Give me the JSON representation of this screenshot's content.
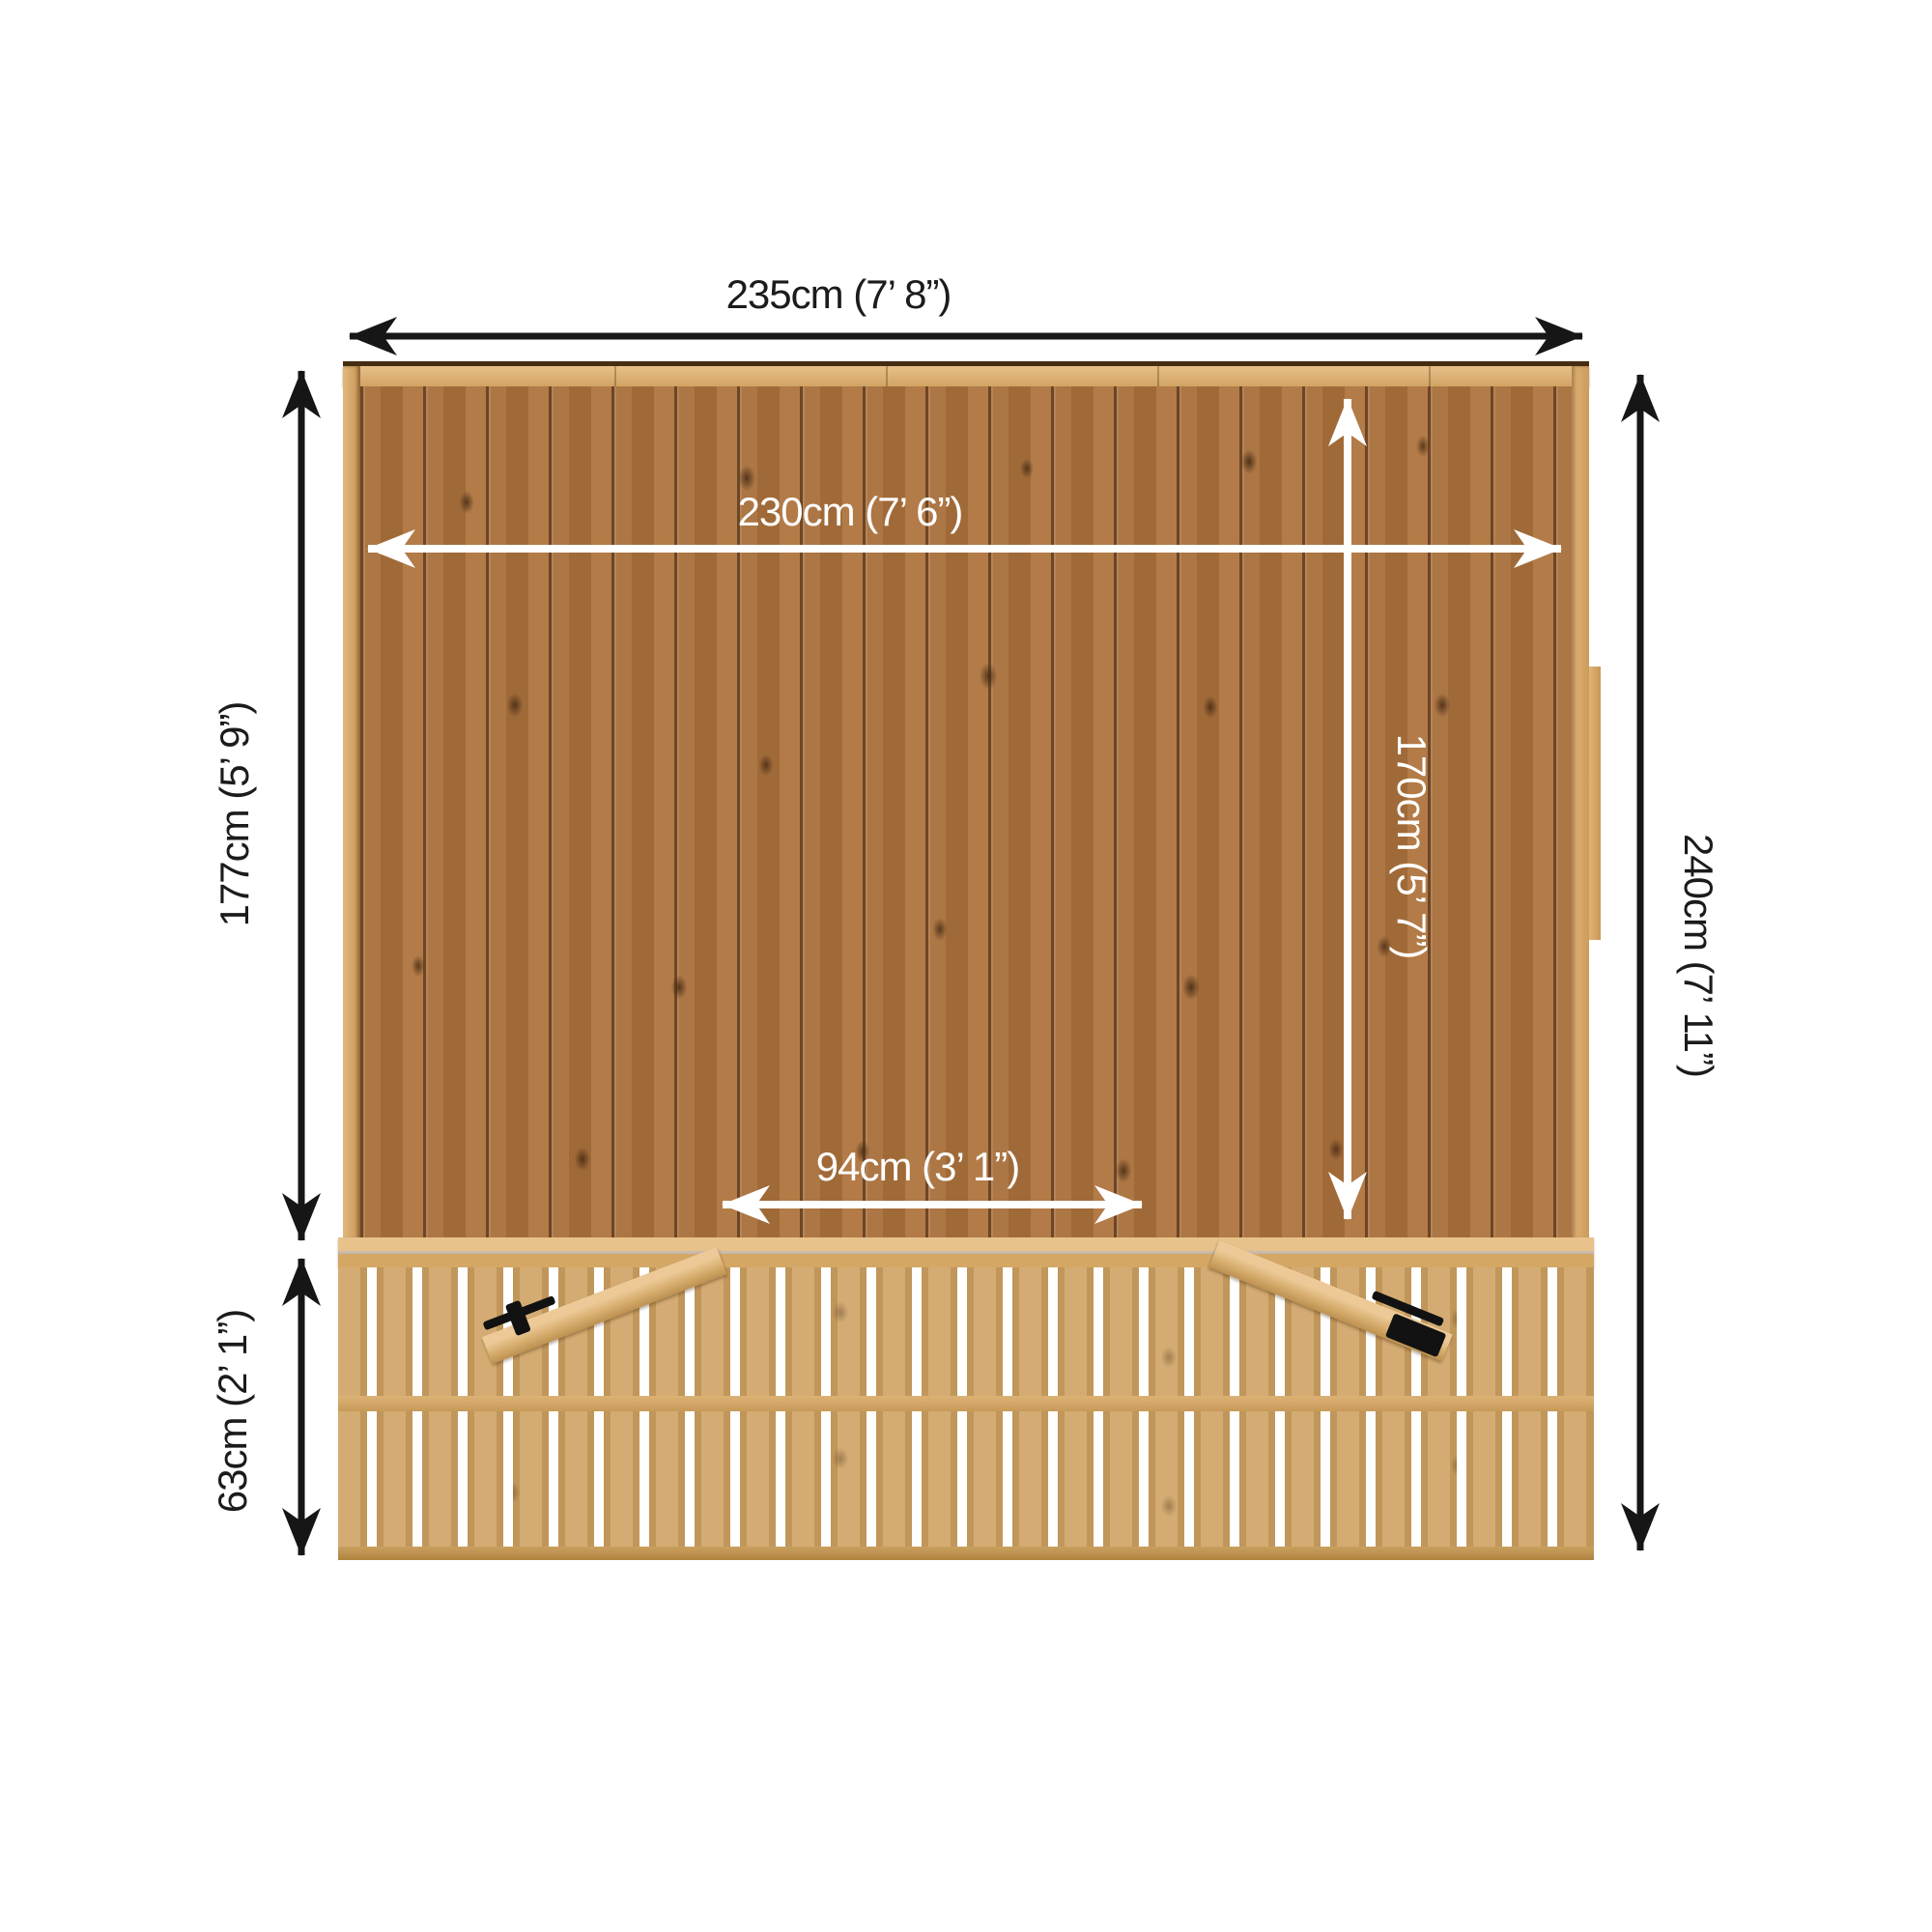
{
  "diagram": {
    "labels": {
      "overall_width": "235cm (7’ 8”)",
      "internal_width": "230cm (7’ 6”)",
      "wall_height": "177cm (5’ 9”)",
      "internal_height": "170cm (5’ 7”)",
      "overall_height": "240cm (7’ 11”)",
      "hatch_width": "94cm (3’ 1”)",
      "base_height": "63cm (2’ 1”)"
    },
    "colors": {
      "background": "#ffffff",
      "dimension_arrow_black": "#161616",
      "dimension_arrow_white": "#ffffff",
      "wall_wood": "#a8703d",
      "frame_wood": "#dcb278",
      "slat_wood": "#cfa363"
    }
  }
}
